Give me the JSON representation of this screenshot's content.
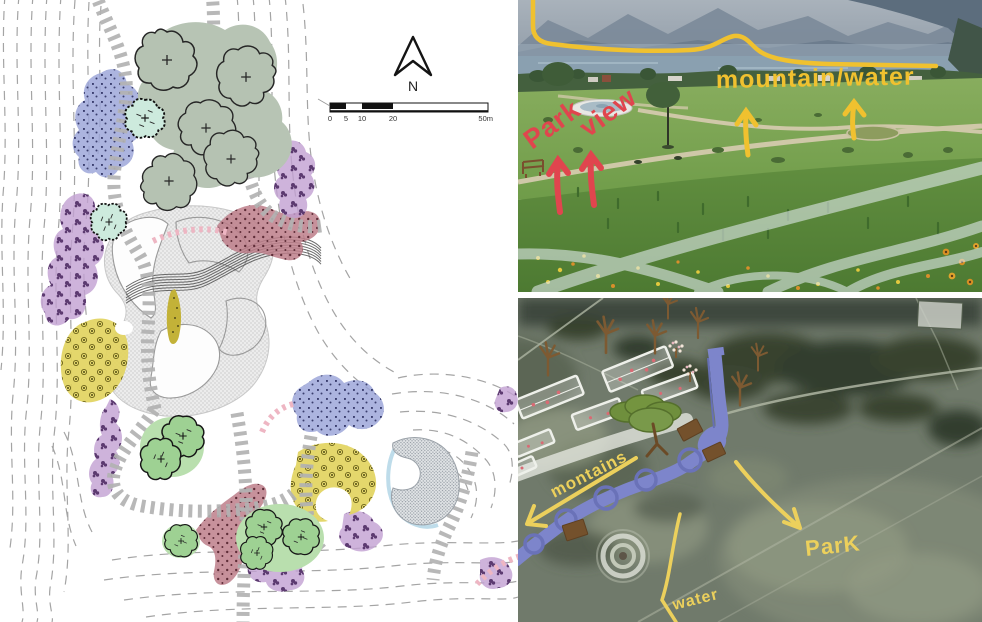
{
  "plan": {
    "north_label": "N",
    "scale_ticks": [
      "0",
      "5",
      "10",
      "20",
      "50m"
    ],
    "colors": {
      "tree_sage": "#b5c2b2",
      "tree_mint": "#cdeadd",
      "tree_green": "#9ed193",
      "bed_purple": "#c2a0d2",
      "bed_blue": "#9aa3d8",
      "bed_rose": "#bd7e8a",
      "bed_yellow": "#e2d45f",
      "path_gray": "#b2b2b2",
      "accent_pink": "#eeb6c3"
    }
  },
  "photo_top": {
    "label_mountain_water": "mountain/water",
    "label_park": "Park",
    "label_view": "view",
    "marker_yellow": "#f0c12f",
    "marker_red": "#e0454e"
  },
  "photo_bottom": {
    "label_montains": "montains",
    "label_park": "ParK",
    "label_water": "water",
    "marker_yellow": "#ecd05c",
    "river_blue": "#7d85cb"
  }
}
